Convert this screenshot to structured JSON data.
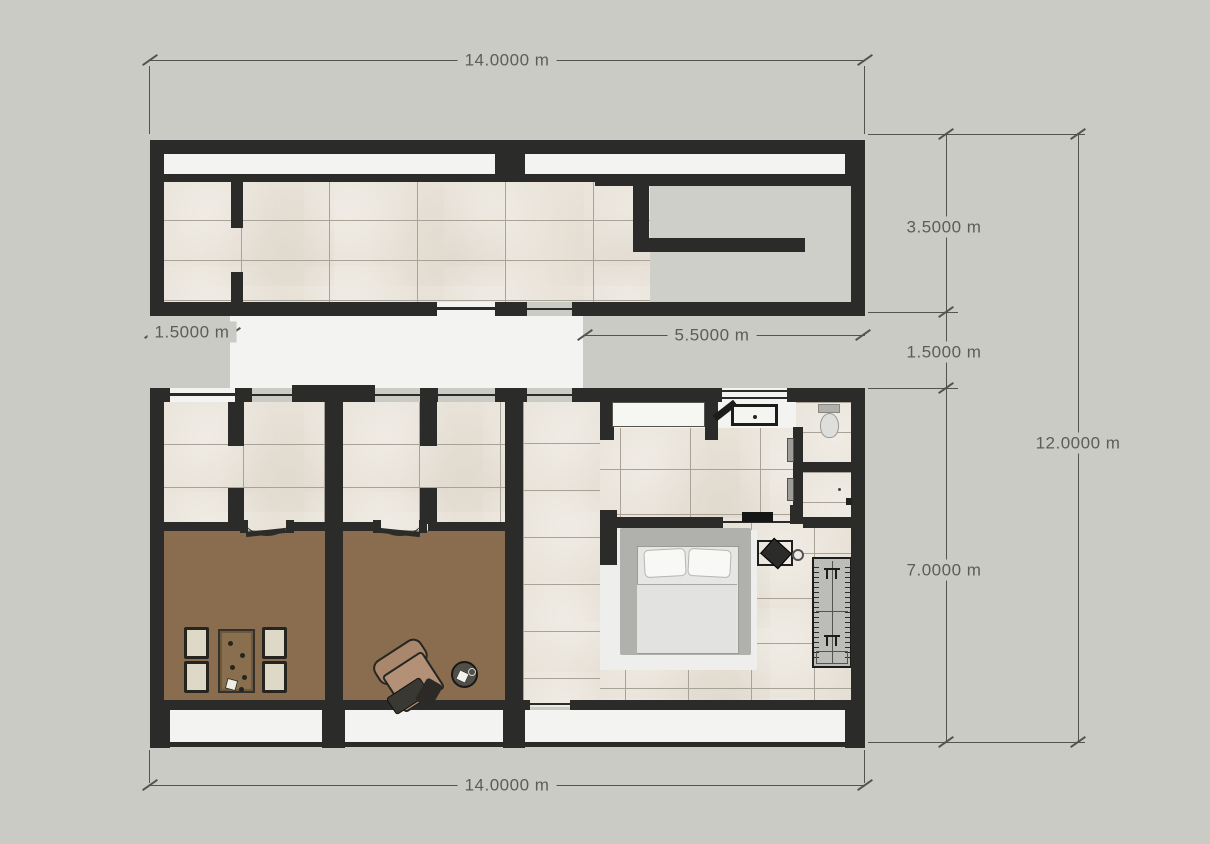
{
  "drawing": {
    "type": "floor-plan",
    "units": "m"
  },
  "dims": {
    "top_width": "14.0000 m",
    "bottom_width": "14.0000 m",
    "upper_section_height": "3.5000 m",
    "middle_gap_height": "1.5000 m",
    "lower_section_height": "7.0000 m",
    "overall_height": "12.0000 m",
    "left_porch_width": "1.5000 m",
    "right_clearance_width": "5.5000 m"
  },
  "colors": {
    "bg": "#cbcbc5",
    "wall": "#2b2b29",
    "tile": "#e9e3d9",
    "grout": "#a9a296",
    "floor_white": "#f3f3f1",
    "floor_brown": "#8a6d4f",
    "room_gray": "#cfcfc9",
    "dim": "#55534f",
    "dim_text": "#5c5c5a",
    "wood": "#8a6f4e",
    "rug": "#eeeeec",
    "mattress": "#e6e6e4",
    "wardrobe": "#bcbcb8"
  }
}
